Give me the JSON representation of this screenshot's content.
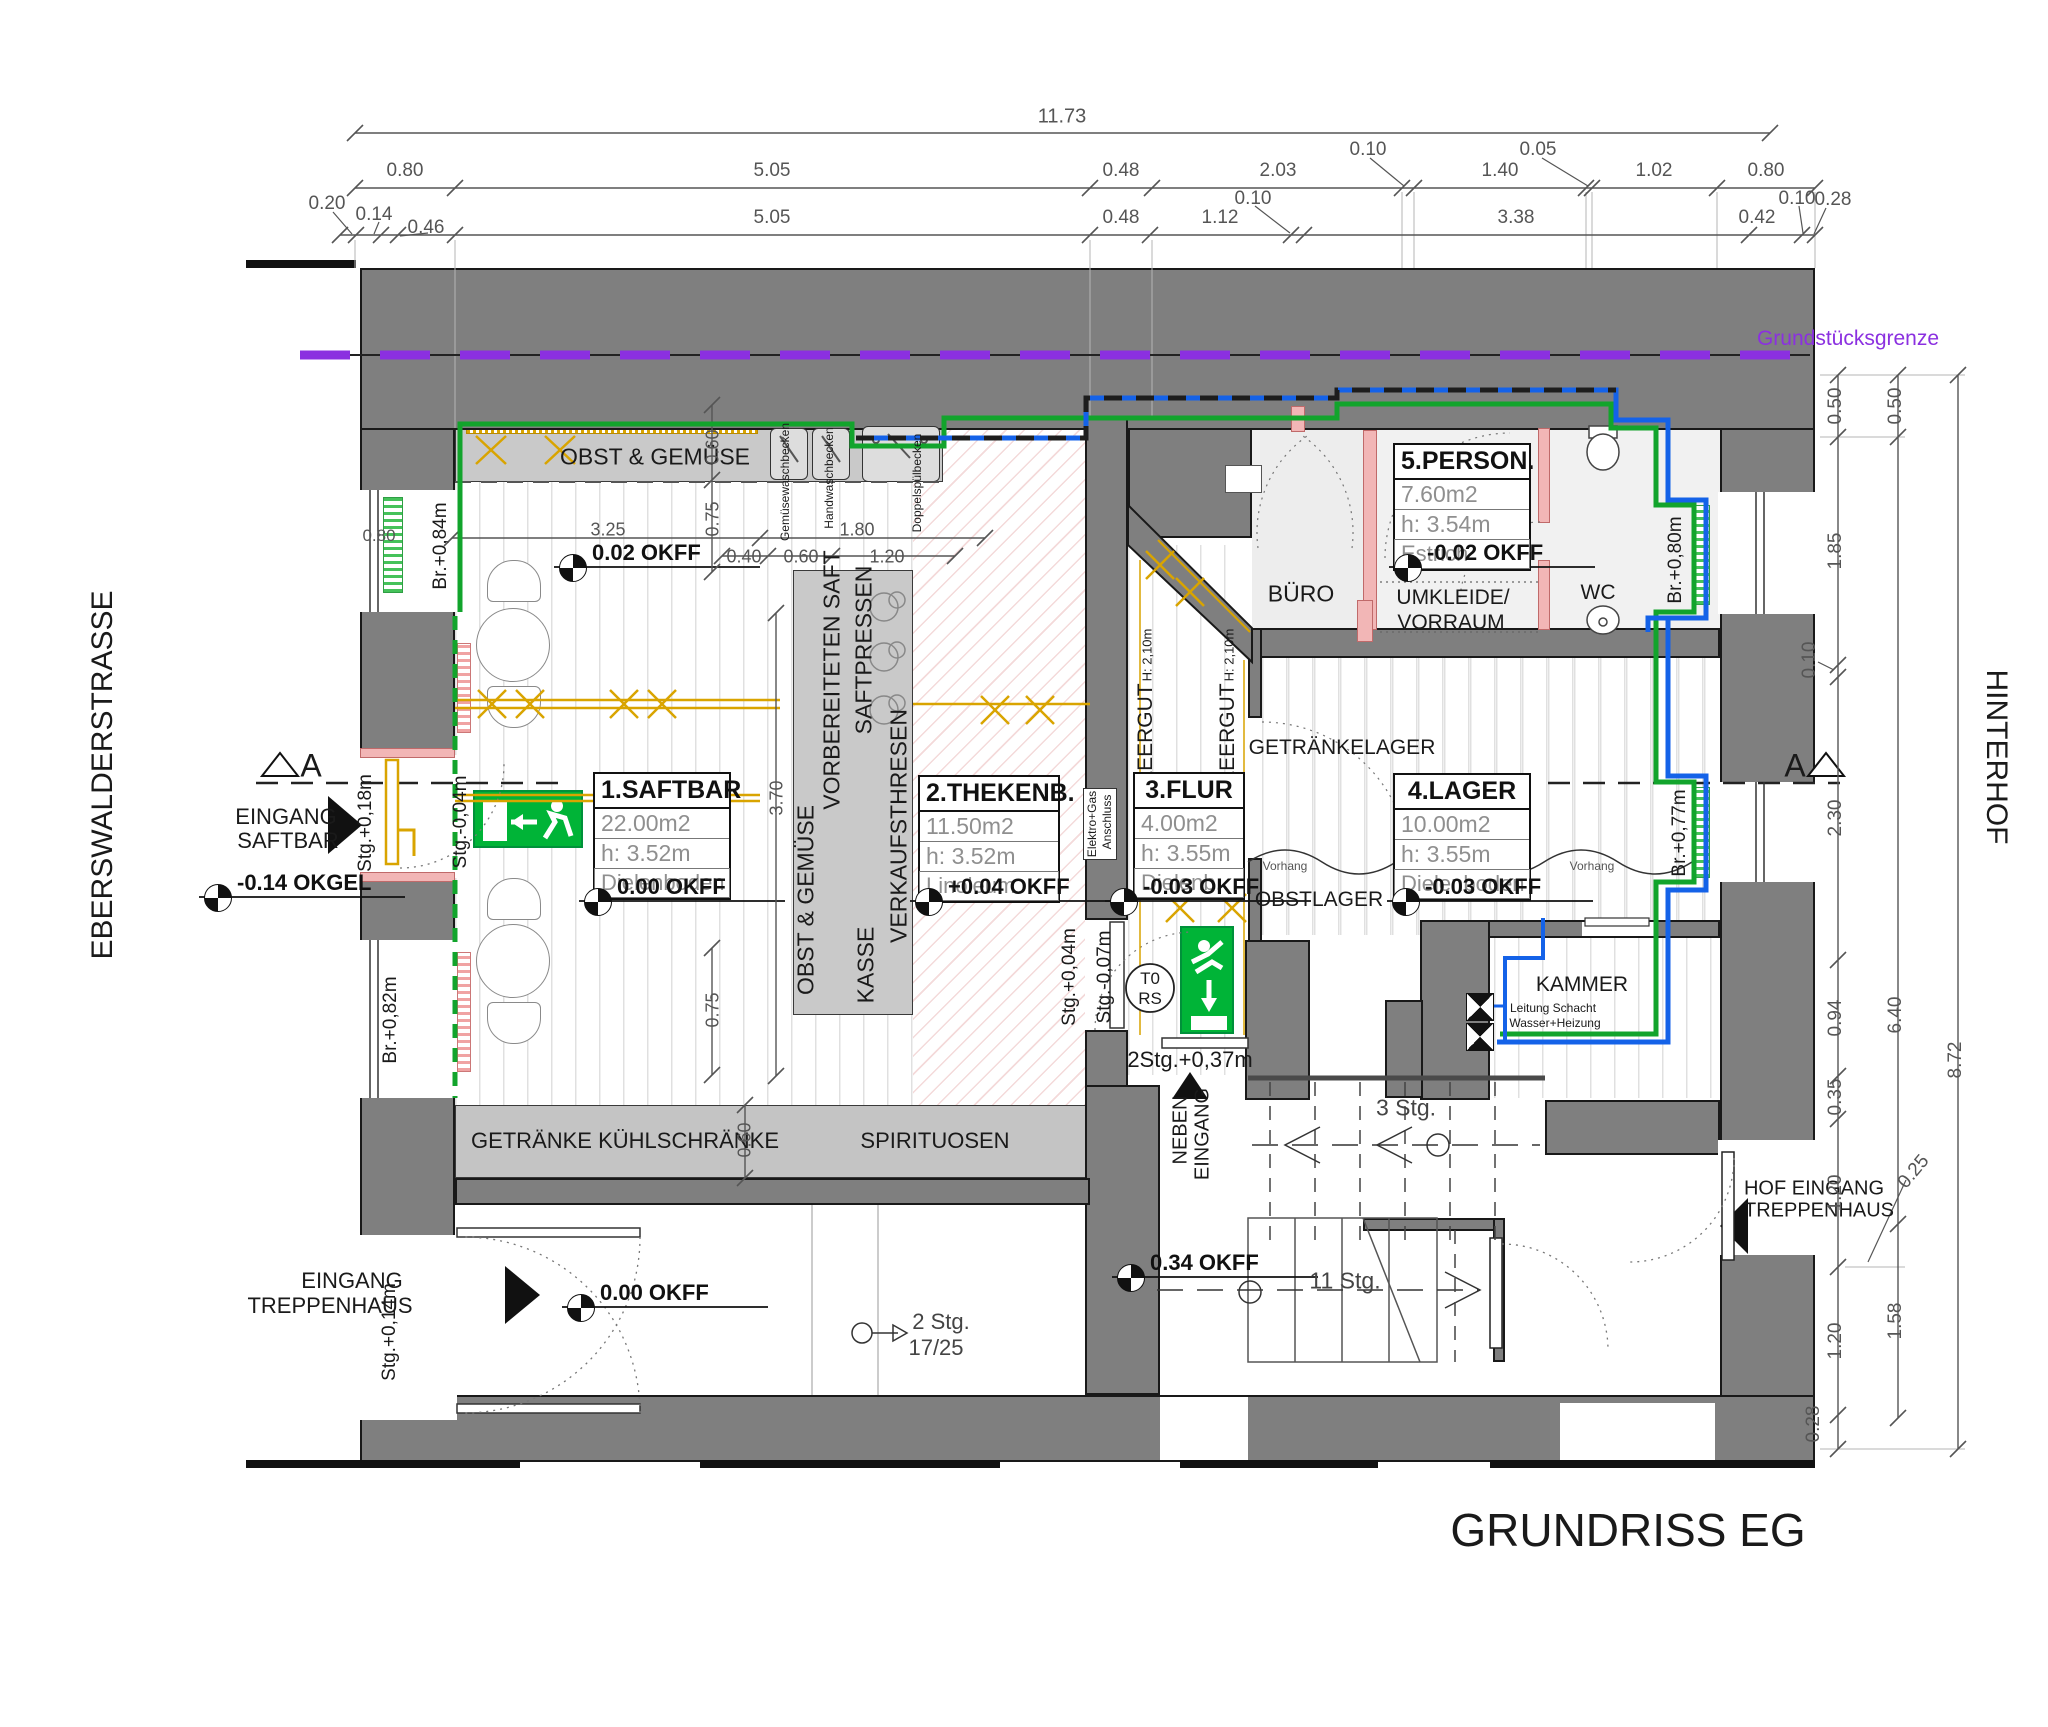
{
  "title": "GRUNDRISS EG",
  "boundary": "Grundstücksgrenze",
  "colors": {
    "wall": "#7f7f7f",
    "green_pipe": "#12a42c",
    "blue_pipe": "#1462e8",
    "boundary_purple": "#8b30e0",
    "gold": "#d9a400",
    "exit_green": "#00b437",
    "pink": "#f2b6b6"
  },
  "rooms": [
    {
      "name": "1.SAFTBAR",
      "area": "22.00m2",
      "h": "h: 3.52m",
      "floor": "Dielenboden",
      "x": 593,
      "y": 772,
      "w": 138
    },
    {
      "name": "2.THEKENB.",
      "area": "11.50m2",
      "h": "h: 3.52m",
      "floor": "Linoleum",
      "x": 918,
      "y": 775,
      "w": 142
    },
    {
      "name": "3.FLUR",
      "area": "4.00m2",
      "h": "h: 3.55m",
      "floor": "Dielenb.",
      "x": 1133,
      "y": 772,
      "w": 112
    },
    {
      "name": "4.LAGER",
      "area": "10.00m2",
      "h": "h: 3.55m",
      "floor": "Dielenboden",
      "x": 1393,
      "y": 773,
      "w": 138
    },
    {
      "name": "5.PERSON.",
      "area": "7.60m2",
      "h": "h: 3.54m",
      "floor": "Estrich",
      "x": 1393,
      "y": 443,
      "w": 138
    }
  ],
  "levels": [
    {
      "t": "0.02 OKFF",
      "x": 592,
      "y": 540
    },
    {
      "t": "0.00 OKFF",
      "x": 617,
      "y": 874
    },
    {
      "t": "+0.04 OKFF",
      "x": 948,
      "y": 874
    },
    {
      "t": "-0.03 OKFF",
      "x": 1143,
      "y": 874
    },
    {
      "t": "-0.03 OKFF",
      "x": 1425,
      "y": 874
    },
    {
      "t": "-0.02 OKFF",
      "x": 1427,
      "y": 540
    },
    {
      "t": "-0.14 OKGEL",
      "x": 237,
      "y": 870
    },
    {
      "t": "0.00 OKFF",
      "x": 600,
      "y": 1280
    },
    {
      "t": "0.34 OKFF",
      "x": 1150,
      "y": 1250
    }
  ],
  "labels": [
    {
      "n": "plan-title",
      "t": "GRUNDRISS EG",
      "x": 1628,
      "y": 1530,
      "fs": 46
    },
    {
      "n": "street-label",
      "t": "EBERSWALDERSTRASSE",
      "x": 103,
      "y": 775,
      "rot": -90,
      "fs": 30
    },
    {
      "n": "courtyard-label",
      "t": "HINTERHOF",
      "x": 1996,
      "y": 757,
      "rot": 90,
      "fs": 30
    },
    {
      "n": "boundary-label",
      "t": "Grundstücksgrenze",
      "x": 1848,
      "y": 339,
      "fs": 21,
      "c": "#8b30e0"
    },
    {
      "t": "OBST & GEMÜSE",
      "x": 655,
      "y": 457,
      "fs": 23
    },
    {
      "t": "GETRÄNKE KÜHLSCHRÄNKE",
      "x": 625,
      "y": 1141,
      "fs": 22
    },
    {
      "t": "SPIRITUOSEN",
      "x": 935,
      "y": 1141,
      "fs": 22
    },
    {
      "t": "KASSE",
      "x": 866,
      "y": 965,
      "rot": -90,
      "fs": 23
    },
    {
      "t": "VERKAUFSTHRESEN",
      "x": 899,
      "y": 826,
      "rot": -90,
      "fs": 23
    },
    {
      "t": "OBST & GEMÜSE",
      "x": 806,
      "y": 900,
      "rot": -90,
      "fs": 23
    },
    {
      "t": "VORBEREITETEN SAFT",
      "x": 832,
      "y": 680,
      "rot": -90,
      "fs": 23
    },
    {
      "t": "SAFTPRESSEN",
      "x": 864,
      "y": 650,
      "rot": -90,
      "fs": 23
    },
    {
      "t": "Gemüsewaschbecken",
      "x": 785,
      "y": 482,
      "rot": -90,
      "fs": 12
    },
    {
      "t": "Handwaschbecken",
      "x": 829,
      "y": 478,
      "rot": -90,
      "fs": 12
    },
    {
      "t": "Doppelspülbecken",
      "x": 917,
      "y": 483,
      "rot": -90,
      "fs": 12
    },
    {
      "t": "BÜRO",
      "x": 1301,
      "y": 594,
      "fs": 23
    },
    {
      "t": "UMKLEIDE/",
      "x": 1453,
      "y": 598,
      "fs": 21
    },
    {
      "t": "VORRAUM",
      "x": 1451,
      "y": 623,
      "fs": 21
    },
    {
      "t": "WC",
      "x": 1598,
      "y": 593,
      "fs": 21
    },
    {
      "t": "GETRÄNKELAGER",
      "x": 1342,
      "y": 748,
      "fs": 21
    },
    {
      "t": "OBSTLAGER",
      "x": 1319,
      "y": 900,
      "fs": 21
    },
    {
      "t": "KAMMER",
      "x": 1582,
      "y": 985,
      "fs": 21
    },
    {
      "t": "Vorhang",
      "x": 1285,
      "y": 866,
      "fs": 12,
      "c": "#555"
    },
    {
      "t": "Vorhang",
      "x": 1592,
      "y": 866,
      "fs": 12,
      "c": "#555"
    },
    {
      "t": "Leitung Schacht",
      "x": 1553,
      "y": 1008,
      "fs": 12
    },
    {
      "t": "Wasser+Heizung",
      "x": 1555,
      "y": 1023,
      "fs": 12
    },
    {
      "t": "LEERGUT",
      "x": 1146,
      "y": 733,
      "rot": -90,
      "fs": 21
    },
    {
      "t": "H: 2,10m",
      "x": 1147,
      "y": 655,
      "rot": -90,
      "fs": 13
    },
    {
      "t": "LEERGUT",
      "x": 1228,
      "y": 733,
      "rot": -90,
      "fs": 21
    },
    {
      "t": "H: 2,10m",
      "x": 1229,
      "y": 655,
      "rot": -90,
      "fs": 13
    },
    {
      "t": "Elektro+Gas",
      "x": 1092,
      "y": 824,
      "rot": -90,
      "fs": 12
    },
    {
      "t": "Anschluss",
      "x": 1107,
      "y": 822,
      "rot": -90,
      "fs": 12
    },
    {
      "t": "EINGANG",
      "x": 286,
      "y": 817,
      "fs": 22
    },
    {
      "t": "SAFTBAR",
      "x": 288,
      "y": 841,
      "fs": 22
    },
    {
      "t": "EINGANG",
      "x": 352,
      "y": 1281,
      "fs": 22
    },
    {
      "t": "TREPPENHAUS",
      "x": 330,
      "y": 1306,
      "fs": 22
    },
    {
      "t": "NEBEN",
      "x": 1181,
      "y": 1130,
      "rot": -90,
      "fs": 20
    },
    {
      "t": "EINGANG",
      "x": 1203,
      "y": 1134,
      "rot": -90,
      "fs": 20
    },
    {
      "t": "HOF EINGANG",
      "x": 1814,
      "y": 1189,
      "fs": 20
    },
    {
      "t": "TREPPENHAUS",
      "x": 1819,
      "y": 1211,
      "fs": 20
    },
    {
      "t": "Stg.+0,18m",
      "x": 366,
      "y": 823,
      "rot": -90,
      "fs": 19
    },
    {
      "t": "Stg.-0,04m",
      "x": 461,
      "y": 822,
      "rot": -90,
      "fs": 19
    },
    {
      "t": "Br.+0,84m",
      "x": 441,
      "y": 546,
      "rot": -90,
      "fs": 19
    },
    {
      "t": "Br.+0,82m",
      "x": 391,
      "y": 1020,
      "rot": -90,
      "fs": 19
    },
    {
      "t": "Stg.+0,14m",
      "x": 390,
      "y": 1332,
      "rot": -90,
      "fs": 19
    },
    {
      "t": "Br.+0,80m",
      "x": 1676,
      "y": 560,
      "rot": -90,
      "fs": 19
    },
    {
      "t": "Br.+0,77m",
      "x": 1680,
      "y": 833,
      "rot": -90,
      "fs": 19
    },
    {
      "t": "Stg.+0,04m",
      "x": 1070,
      "y": 977,
      "rot": -90,
      "fs": 19
    },
    {
      "t": "Stg.-0,07m",
      "x": 1105,
      "y": 977,
      "rot": -90,
      "fs": 19
    },
    {
      "t": "2Stg.+0,37m",
      "x": 1190,
      "y": 1060,
      "fs": 22
    },
    {
      "t": "2 Stg.",
      "x": 941,
      "y": 1322,
      "fs": 22,
      "c": "#444"
    },
    {
      "t": "17/25",
      "x": 936,
      "y": 1348,
      "fs": 22,
      "c": "#444"
    },
    {
      "t": "3 Stg.",
      "x": 1406,
      "y": 1108,
      "fs": 23,
      "c": "#444"
    },
    {
      "t": "11 Stg.",
      "x": 1345,
      "y": 1281,
      "fs": 23,
      "c": "#444"
    },
    {
      "t": "T0",
      "x": 1150,
      "y": 979,
      "fs": 17
    },
    {
      "t": "RS",
      "x": 1150,
      "y": 999,
      "fs": 17
    },
    {
      "t": "A",
      "x": 311,
      "y": 766,
      "fs": 32
    },
    {
      "t": "A",
      "x": 1795,
      "y": 766,
      "fs": 32
    },
    {
      "t": "11.73",
      "x": 1062,
      "y": 117,
      "fs": 20,
      "c": "#555"
    },
    {
      "t": "0.80",
      "x": 405,
      "y": 171,
      "fs": 19,
      "c": "#555"
    },
    {
      "t": "5.05",
      "x": 772,
      "y": 171,
      "fs": 19,
      "c": "#555"
    },
    {
      "t": "0.48",
      "x": 1121,
      "y": 171,
      "fs": 19,
      "c": "#555"
    },
    {
      "t": "2.03",
      "x": 1278,
      "y": 171,
      "fs": 19,
      "c": "#555"
    },
    {
      "t": "0.10",
      "x": 1368,
      "y": 150,
      "fs": 19,
      "c": "#555"
    },
    {
      "t": "1.40",
      "x": 1500,
      "y": 171,
      "fs": 19,
      "c": "#555"
    },
    {
      "t": "0.05",
      "x": 1538,
      "y": 150,
      "fs": 19,
      "c": "#555"
    },
    {
      "t": "1.02",
      "x": 1654,
      "y": 171,
      "fs": 19,
      "c": "#555"
    },
    {
      "t": "0.80",
      "x": 1766,
      "y": 171,
      "fs": 19,
      "c": "#555"
    },
    {
      "t": "0.20",
      "x": 327,
      "y": 204,
      "fs": 19,
      "c": "#555"
    },
    {
      "t": "0.14",
      "x": 374,
      "y": 215,
      "fs": 19,
      "c": "#555"
    },
    {
      "t": "0.46",
      "x": 426,
      "y": 228,
      "fs": 19,
      "c": "#555"
    },
    {
      "t": "5.05",
      "x": 772,
      "y": 218,
      "fs": 19,
      "c": "#555"
    },
    {
      "t": "0.48",
      "x": 1121,
      "y": 218,
      "fs": 19,
      "c": "#555"
    },
    {
      "t": "1.12",
      "x": 1220,
      "y": 218,
      "fs": 19,
      "c": "#555"
    },
    {
      "t": "0.10",
      "x": 1253,
      "y": 199,
      "fs": 19,
      "c": "#555"
    },
    {
      "t": "3.38",
      "x": 1516,
      "y": 218,
      "fs": 19,
      "c": "#555"
    },
    {
      "t": "0.42",
      "x": 1757,
      "y": 218,
      "fs": 19,
      "c": "#555"
    },
    {
      "t": "0.10",
      "x": 1797,
      "y": 199,
      "fs": 19,
      "c": "#555"
    },
    {
      "t": "0.28",
      "x": 1833,
      "y": 200,
      "fs": 19,
      "c": "#555"
    },
    {
      "t": "0.50",
      "x": 1836,
      "y": 406,
      "rot": -90,
      "fs": 19,
      "c": "#555"
    },
    {
      "t": "0.50",
      "x": 1896,
      "y": 406,
      "rot": -90,
      "fs": 19,
      "c": "#555"
    },
    {
      "t": "1.85",
      "x": 1836,
      "y": 551,
      "rot": -90,
      "fs": 19,
      "c": "#555"
    },
    {
      "t": "0.10",
      "x": 1810,
      "y": 660,
      "rot": -90,
      "fs": 19,
      "c": "#555"
    },
    {
      "t": "2.30",
      "x": 1836,
      "y": 818,
      "rot": -90,
      "fs": 19,
      "c": "#555"
    },
    {
      "t": "6.40",
      "x": 1896,
      "y": 1015,
      "rot": -90,
      "fs": 19,
      "c": "#555"
    },
    {
      "t": "8.72",
      "x": 1956,
      "y": 1060,
      "rot": -90,
      "fs": 19,
      "c": "#555"
    },
    {
      "t": "0.94",
      "x": 1836,
      "y": 1018,
      "rot": -90,
      "fs": 19,
      "c": "#555"
    },
    {
      "t": "0.35",
      "x": 1836,
      "y": 1097,
      "rot": -90,
      "fs": 19,
      "c": "#555"
    },
    {
      "t": "1.20",
      "x": 1836,
      "y": 1193,
      "rot": -90,
      "fs": 19,
      "c": "#555"
    },
    {
      "t": "0.25",
      "x": 1914,
      "y": 1172,
      "rot": -50,
      "fs": 19,
      "c": "#555"
    },
    {
      "t": "1.20",
      "x": 1836,
      "y": 1341,
      "rot": -90,
      "fs": 19,
      "c": "#555"
    },
    {
      "t": "1.58",
      "x": 1896,
      "y": 1321,
      "rot": -90,
      "fs": 19,
      "c": "#555"
    },
    {
      "t": "0.28",
      "x": 1814,
      "y": 1424,
      "rot": -90,
      "fs": 19,
      "c": "#555"
    },
    {
      "t": "3.25",
      "x": 608,
      "y": 530,
      "fs": 18,
      "c": "#555"
    },
    {
      "t": "1.80",
      "x": 857,
      "y": 530,
      "fs": 18,
      "c": "#555"
    },
    {
      "t": "0.40",
      "x": 744,
      "y": 557,
      "fs": 18,
      "c": "#555"
    },
    {
      "t": "0.60",
      "x": 801,
      "y": 557,
      "fs": 18,
      "c": "#555"
    },
    {
      "t": "1.20",
      "x": 887,
      "y": 557,
      "fs": 18,
      "c": "#555"
    },
    {
      "t": "0.60",
      "x": 713,
      "y": 447,
      "rot": -90,
      "fs": 18,
      "c": "#555"
    },
    {
      "t": "0.75",
      "x": 713,
      "y": 519,
      "rot": -90,
      "fs": 18,
      "c": "#555"
    },
    {
      "t": "3.70",
      "x": 777,
      "y": 798,
      "rot": -90,
      "fs": 18,
      "c": "#555"
    },
    {
      "t": "0.75",
      "x": 713,
      "y": 1010,
      "rot": -90,
      "fs": 18,
      "c": "#555"
    },
    {
      "t": "0.60",
      "x": 745,
      "y": 1140,
      "rot": -90,
      "fs": 18,
      "c": "#555"
    },
    {
      "t": "0.80",
      "x": 379,
      "y": 536,
      "fs": 17,
      "c": "#555"
    }
  ],
  "chains": [
    {
      "axis": "h",
      "pos": 133,
      "from": 355,
      "to": 1770,
      "ticks": [
        355,
        1770
      ]
    },
    {
      "axis": "h",
      "pos": 188,
      "from": 355,
      "to": 1815,
      "ticks": [
        355,
        455,
        1090,
        1152,
        1402,
        1414,
        1586,
        1592,
        1717,
        1815
      ]
    },
    {
      "axis": "h",
      "pos": 235,
      "from": 340,
      "to": 1815,
      "ticks": [
        340,
        356,
        381,
        398,
        455,
        1090,
        1150,
        1291,
        1304,
        1749,
        1802,
        1815
      ]
    },
    {
      "axis": "h",
      "pos": 538,
      "from": 452,
      "to": 985,
      "ticks": [
        452,
        760,
        985
      ]
    },
    {
      "axis": "h",
      "pos": 556,
      "from": 722,
      "to": 955,
      "ticks": [
        722,
        768,
        832,
        955
      ]
    },
    {
      "axis": "v",
      "pos": 1838,
      "from": 375,
      "to": 1449,
      "ticks": [
        375,
        437,
        665,
        677,
        960,
        1076,
        1119,
        1267,
        1415,
        1449
      ]
    },
    {
      "axis": "v",
      "pos": 1898,
      "from": 375,
      "to": 1418,
      "ticks": [
        375,
        437,
        1224,
        1418
      ]
    },
    {
      "axis": "v",
      "pos": 1958,
      "from": 375,
      "to": 1449,
      "ticks": [
        375,
        1449
      ]
    },
    {
      "axis": "v",
      "pos": 712,
      "from": 405,
      "to": 572,
      "ticks": [
        405,
        480,
        572
      ]
    },
    {
      "axis": "v",
      "pos": 776,
      "from": 613,
      "to": 1076,
      "ticks": [
        613,
        1076
      ]
    },
    {
      "axis": "v",
      "pos": 712,
      "from": 948,
      "to": 1075,
      "ticks": [
        948,
        1075
      ]
    },
    {
      "axis": "v",
      "pos": 745,
      "from": 1105,
      "to": 1178,
      "ticks": [
        1105,
        1178
      ]
    }
  ],
  "pipes": [
    {
      "name": "boundary-underlay",
      "c": "#222222",
      "w": 2,
      "pts": [
        [
          300,
          355
        ],
        [
          1810,
          355
        ]
      ]
    },
    {
      "name": "property-boundary",
      "c": "#8b30e0",
      "w": 9,
      "dash": [
        50,
        30
      ],
      "pts": [
        [
          300,
          355
        ],
        [
          1810,
          355
        ]
      ]
    },
    {
      "name": "green-pipe",
      "c": "#12a42c",
      "w": 5,
      "pts": [
        [
          460,
          612
        ],
        [
          460,
          424
        ],
        [
          852,
          424
        ],
        [
          852,
          446
        ],
        [
          944,
          446
        ],
        [
          944,
          418
        ],
        [
          1337,
          418
        ],
        [
          1337,
          404
        ],
        [
          1611,
          404
        ],
        [
          1611,
          428
        ],
        [
          1656,
          428
        ],
        [
          1656,
          505
        ],
        [
          1694,
          505
        ],
        [
          1694,
          612
        ],
        [
          1656,
          612
        ],
        [
          1656,
          782
        ],
        [
          1694,
          782
        ],
        [
          1694,
          882
        ],
        [
          1656,
          882
        ],
        [
          1656,
          1034
        ],
        [
          1500,
          1034
        ]
      ]
    },
    {
      "name": "green-pipe-dashed",
      "c": "#12a42c",
      "w": 5,
      "dash": [
        14,
        10
      ],
      "pts": [
        [
          455,
          616
        ],
        [
          455,
          1098
        ]
      ]
    },
    {
      "name": "blue-pipe-top",
      "c": "#1462e8",
      "w": 5,
      "pts": [
        [
          856,
          438
        ],
        [
          1086,
          438
        ],
        [
          1086,
          398
        ],
        [
          1337,
          398
        ],
        [
          1337,
          390
        ],
        [
          1616,
          390
        ],
        [
          1616,
          420
        ],
        [
          1668,
          420
        ],
        [
          1668,
          500
        ],
        [
          1706,
          500
        ],
        [
          1706,
          618
        ],
        [
          1648,
          618
        ],
        [
          1648,
          632
        ]
      ]
    },
    {
      "name": "blue-pipe-top-dash",
      "c": "#1d1d1d",
      "w": 5,
      "dash": [
        18,
        14
      ],
      "pts": [
        [
          856,
          438
        ],
        [
          1086,
          438
        ],
        [
          1086,
          398
        ],
        [
          1337,
          398
        ],
        [
          1337,
          390
        ],
        [
          1616,
          390
        ]
      ]
    },
    {
      "name": "blue-pipe-right",
      "c": "#1462e8",
      "w": 5,
      "pts": [
        [
          1668,
          618
        ],
        [
          1668,
          776
        ],
        [
          1706,
          776
        ],
        [
          1706,
          890
        ],
        [
          1668,
          890
        ],
        [
          1668,
          1042
        ],
        [
          1497,
          1042
        ]
      ]
    },
    {
      "name": "blue-pipe-kammer",
      "c": "#1462e8",
      "w": 4,
      "pts": [
        [
          1543,
          918
        ],
        [
          1543,
          958
        ],
        [
          1505,
          958
        ],
        [
          1505,
          1042
        ]
      ]
    }
  ]
}
